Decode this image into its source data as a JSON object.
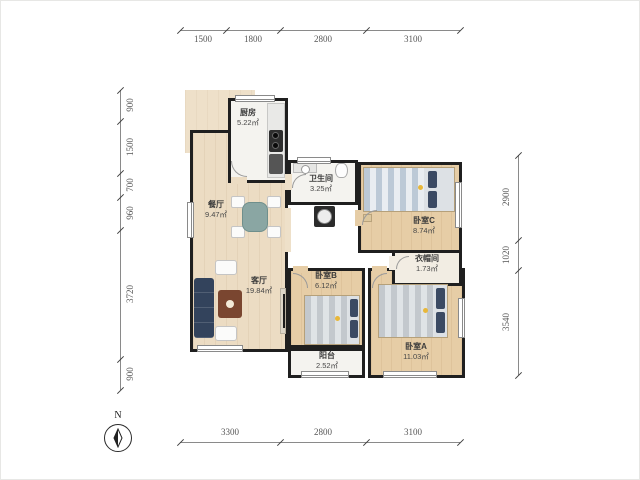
{
  "compass": {
    "label": "N"
  },
  "dims": {
    "top": [
      "1500",
      "1800",
      "2800",
      "3100"
    ],
    "bottom": [
      "3300",
      "2800",
      "3100"
    ],
    "left": [
      "900",
      "1500",
      "700",
      "960",
      "3720",
      "900"
    ],
    "right": [
      "2900",
      "1020",
      "3540"
    ]
  },
  "rooms": {
    "kitchen": {
      "name": "厨房",
      "area": "5.22㎡"
    },
    "bathroom": {
      "name": "卫生间",
      "area": "3.25㎡"
    },
    "dining": {
      "name": "餐厅",
      "area": "9.47㎡"
    },
    "living": {
      "name": "客厅",
      "area": "19.84㎡"
    },
    "bedroomC": {
      "name": "卧室C",
      "area": "8.74㎡"
    },
    "closet": {
      "name": "衣帽间",
      "area": "1.73㎡"
    },
    "bedroomB": {
      "name": "卧室B",
      "area": "6.12㎡"
    },
    "balcony": {
      "name": "阳台",
      "area": "2.52㎡"
    },
    "bedroomA": {
      "name": "卧室A",
      "area": "11.03㎡"
    }
  },
  "colors": {
    "wall": "#1f1f1f",
    "wood": "#ecdcc3",
    "wood_dark": "#e6cda6",
    "tile": "#f4f3ef",
    "sofa": "#33435c",
    "pillow": "#3b4a63",
    "table_wood": "#7a4630",
    "accent": "#e8b73a"
  }
}
